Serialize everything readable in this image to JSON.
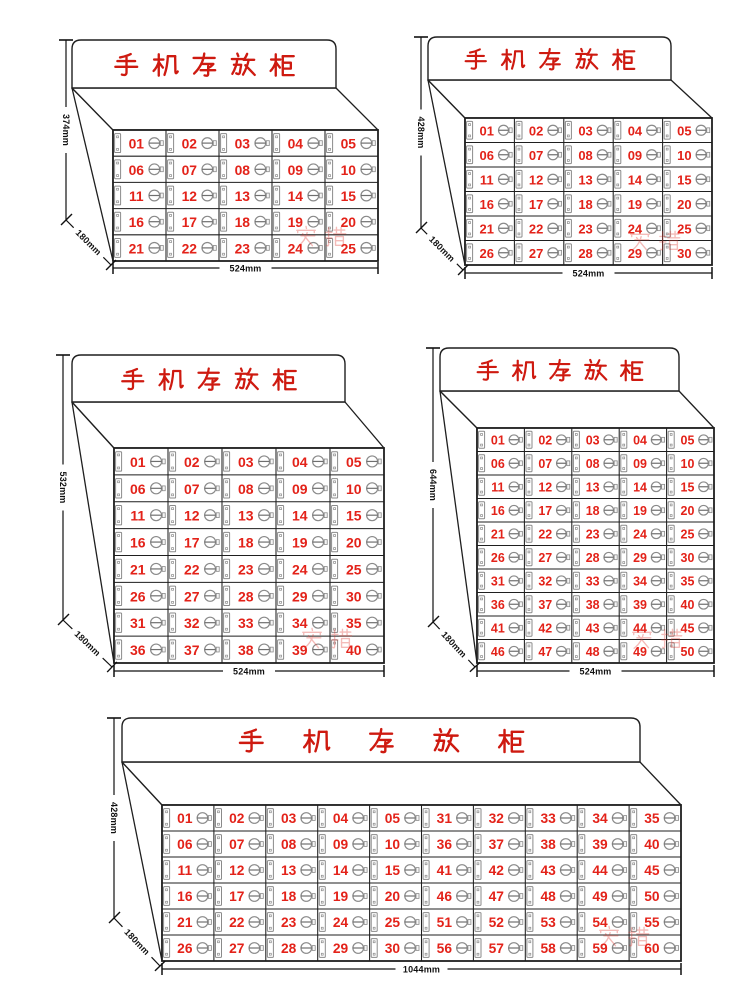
{
  "poster": {
    "background": "#ffffff",
    "product_title": "手机存放柜",
    "watermark": "安措"
  },
  "colors": {
    "title_red": "#ce1a10",
    "number_red": "#e32219",
    "line": "#1f1f1f",
    "hardware_grey": "#8a8a8a",
    "dimension_text": "#111111",
    "watermark_red": "#e0342b"
  },
  "cabinets": [
    {
      "id": "cabinet-25-cell",
      "title": "手机存放柜",
      "rows": 5,
      "columns": 5,
      "cell_count": 25,
      "height_label": "374mm",
      "depth_label": "180mm",
      "width_label": "524mm",
      "cell_numbers": [
        "01",
        "02",
        "03",
        "04",
        "05",
        "06",
        "07",
        "08",
        "09",
        "10",
        "11",
        "12",
        "13",
        "14",
        "15",
        "16",
        "17",
        "18",
        "19",
        "20",
        "21",
        "22",
        "23",
        "24",
        "25"
      ]
    },
    {
      "id": "cabinet-30-cell",
      "title": "手机存放柜",
      "rows": 6,
      "columns": 5,
      "cell_count": 30,
      "height_label": "428mm",
      "depth_label": "180mm",
      "width_label": "524mm",
      "cell_numbers": [
        "01",
        "02",
        "03",
        "04",
        "05",
        "06",
        "07",
        "08",
        "09",
        "10",
        "11",
        "12",
        "13",
        "14",
        "15",
        "16",
        "17",
        "18",
        "19",
        "20",
        "21",
        "22",
        "23",
        "24",
        "25",
        "26",
        "27",
        "28",
        "29",
        "30"
      ]
    },
    {
      "id": "cabinet-40-cell",
      "title": "手机存放柜",
      "rows": 8,
      "columns": 5,
      "cell_count": 40,
      "height_label": "532mm",
      "depth_label": "180mm",
      "width_label": "524mm",
      "cell_numbers": [
        "01",
        "02",
        "03",
        "04",
        "05",
        "06",
        "07",
        "08",
        "09",
        "10",
        "11",
        "12",
        "13",
        "14",
        "15",
        "16",
        "17",
        "18",
        "19",
        "20",
        "21",
        "22",
        "23",
        "24",
        "25",
        "26",
        "27",
        "28",
        "29",
        "30",
        "31",
        "32",
        "33",
        "34",
        "35",
        "36",
        "37",
        "38",
        "39",
        "40"
      ]
    },
    {
      "id": "cabinet-50-cell",
      "title": "手机存放柜",
      "rows": 10,
      "columns": 5,
      "cell_count": 50,
      "height_label": "644mm",
      "depth_label": "180mm",
      "width_label": "524mm",
      "cell_numbers": [
        "01",
        "02",
        "03",
        "04",
        "05",
        "06",
        "07",
        "08",
        "09",
        "10",
        "11",
        "12",
        "13",
        "14",
        "15",
        "16",
        "17",
        "18",
        "19",
        "20",
        "21",
        "22",
        "23",
        "24",
        "25",
        "26",
        "27",
        "28",
        "29",
        "30",
        "31",
        "32",
        "33",
        "34",
        "35",
        "36",
        "37",
        "38",
        "39",
        "40",
        "41",
        "42",
        "43",
        "44",
        "45",
        "46",
        "47",
        "48",
        "49",
        "50"
      ]
    },
    {
      "id": "cabinet-60-cell",
      "title": "手机存放柜",
      "rows": 6,
      "columns": 10,
      "cell_count": 60,
      "height_label": "428mm",
      "depth_label": "180mm",
      "width_label": "1044mm",
      "cell_numbers": [
        "01",
        "02",
        "03",
        "04",
        "05",
        "31",
        "32",
        "33",
        "34",
        "35",
        "06",
        "07",
        "08",
        "09",
        "10",
        "36",
        "37",
        "38",
        "39",
        "40",
        "11",
        "12",
        "13",
        "14",
        "15",
        "41",
        "42",
        "43",
        "44",
        "45",
        "16",
        "17",
        "18",
        "19",
        "20",
        "46",
        "47",
        "48",
        "49",
        "50",
        "21",
        "22",
        "23",
        "24",
        "25",
        "51",
        "52",
        "53",
        "54",
        "55",
        "26",
        "27",
        "28",
        "29",
        "30",
        "56",
        "57",
        "58",
        "59",
        "60"
      ]
    }
  ]
}
